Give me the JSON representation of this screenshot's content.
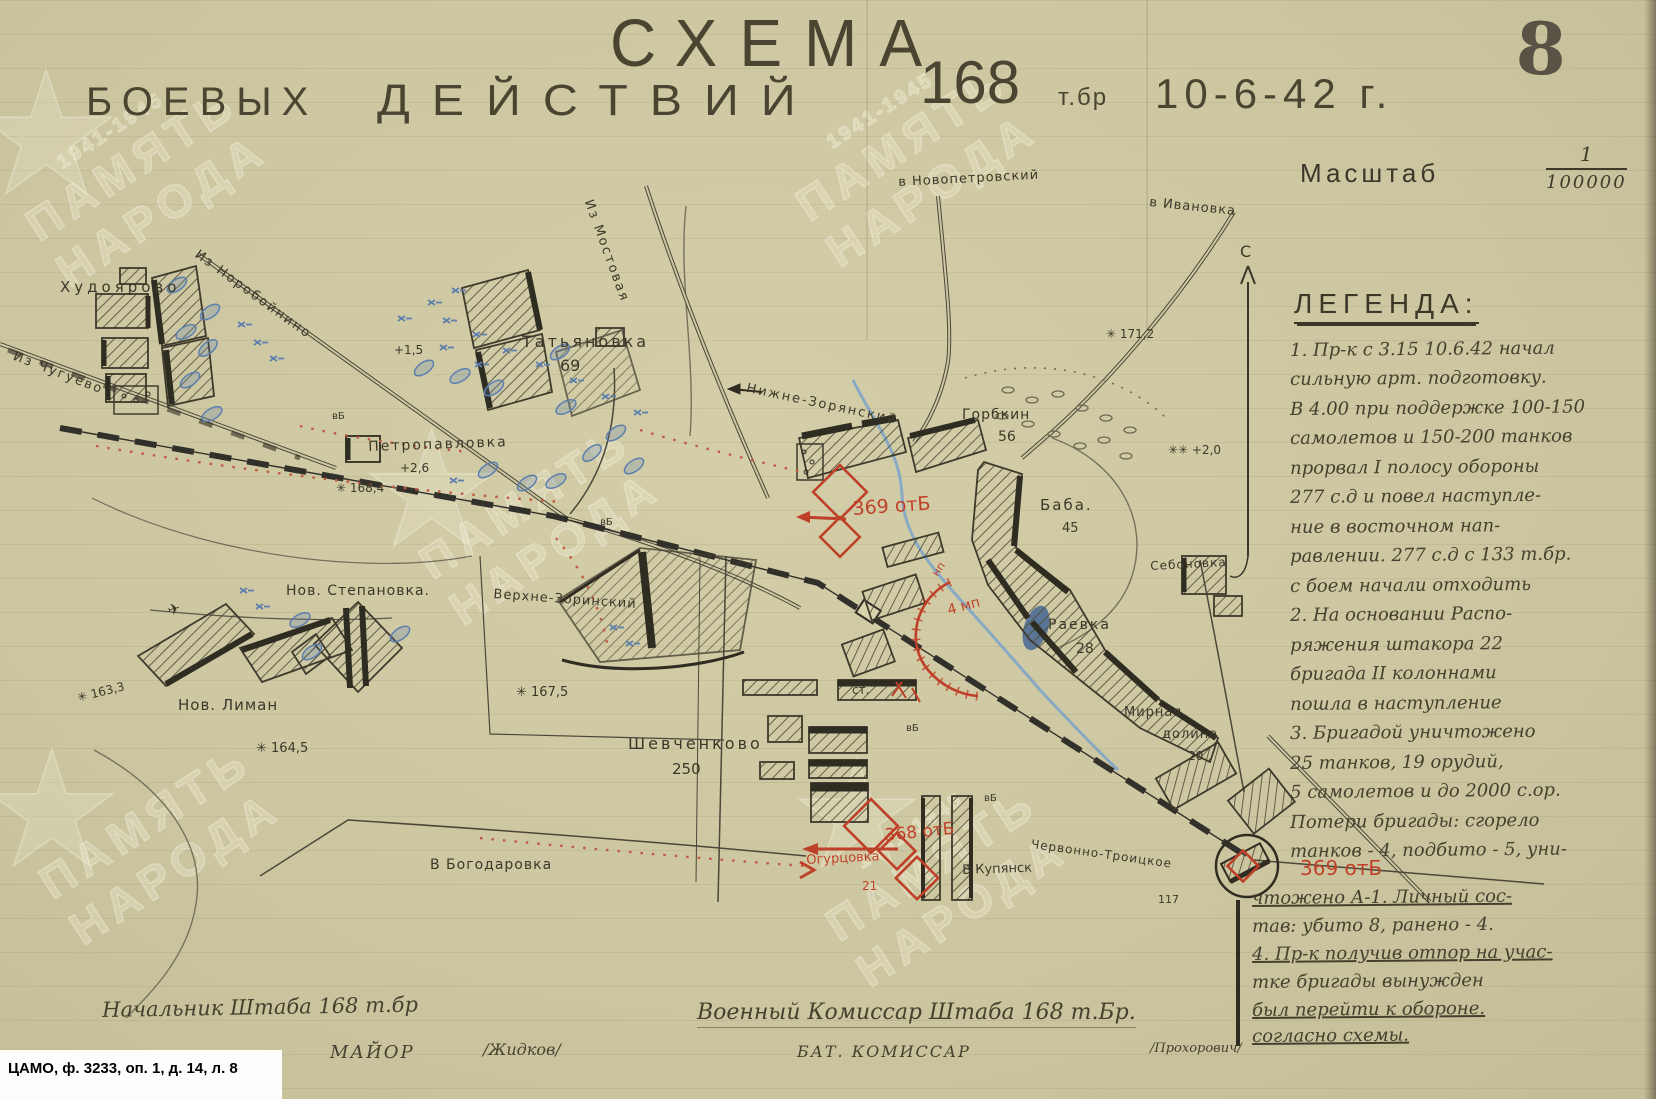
{
  "page": {
    "archive_ref": "ЦАМО, ф. 3233, оп. 1, д. 14, л. 8",
    "page_number": "8",
    "watermark_line1": "ПАМЯТЬ",
    "watermark_line2": "НАРОДА",
    "watermark_years": "1941-1945",
    "star_glyph": "★"
  },
  "header": {
    "title_line1": "СХЕМА",
    "title_word1": "БОЕВЫХ",
    "title_word2": "ДЕЙСТВИЙ",
    "unit_number": "168",
    "unit_suffix": "т.бр",
    "date": "10-6-42 г.",
    "scale_label": "Масштаб",
    "scale_num": "1",
    "scale_den": "100000"
  },
  "legend": {
    "north": "С",
    "title": "ЛЕГЕНДА:",
    "lines": [
      "1. Пр-к с 3.15 10.6.42 начал",
      "сильную арт. подготовку.",
      "В 4.00 при поддержке 100-150",
      "самолетов и 150-200 танков",
      "прорвал I полосу обороны",
      "277 с.д и повел наступле-",
      "ние в восточном нап-",
      "равлении. 277 с.д с 133 т.бр.",
      "с боем начали отходить",
      "2. На основании Распо-",
      "ряжения штакора 22",
      "бригада II колоннами",
      "пошла в наступление",
      "3. Бригадой уничтожено",
      "25 танков, 19 орудий,",
      "5 самолетов и до 2000 с.ор.",
      "Потери бригады: сгорело",
      "танков - 4, подбито - 5, уни-",
      "чтожено А-1. Личный сос-",
      "тав: убито 8, ранено - 4.",
      "4. Пр-к получив отпор на учас-",
      "тке бригады вынужден",
      "был перейти к обороне.",
      "согласно схемы."
    ]
  },
  "map": {
    "labels": {
      "hudoyarovo": "Худоярово",
      "iz_chugueva": "Из Чугуево",
      "iz_noroboynino": "Из Норобойнино",
      "iz_mostovaya": "Из Мостовая",
      "v_novopetrovskiy": "в Новопетровский",
      "v_ivanovka": "в Ивановка",
      "tatyanovka": "Татьяновка",
      "tatyanovka_h": "69",
      "petropavlovka": "Петропавловка",
      "plus26": "+2,6",
      "plus15": "+1,5",
      "h1684": "✳ 168,4",
      "nizhne_zorinskiy": "Нижне-Зорянский",
      "gorbkin": "Горбкин",
      "gorbkin_h": "56",
      "baba": "Баба.",
      "baba_h": "45",
      "raevka": "Раевка",
      "raevka_h": "28",
      "mirnaya1": "Мирная",
      "mirnaya2": "долина",
      "mirnaya_h": "20",
      "sebonovka": "Себоновка",
      "nov_stepanovka": "Нов. Степановка.",
      "verhne_zorinskiy": "Верхне-Зоринский",
      "h1675": "✳ 167,5",
      "nov_liman": "Нов. Лиман",
      "h1633": "✳ 163,3",
      "h1645": "✳ 164,5",
      "shevchenkovo": "Шевченково",
      "shevchenkovo_h": "250",
      "st": "ст.",
      "ogurtsovka": "Огурцовка",
      "ogurtsovka_h": "21",
      "otb368": "368 отБ",
      "otb369a": "369 отБ",
      "otb369b": "369 отБ",
      "mp4": "4 мп",
      "np": "нп",
      "chervonno": "Червонно-Троицкое",
      "chervonno_h": "117",
      "v_bogodarovka": "В Богодаровка",
      "v_kupyansk": "В Купянск",
      "h1712": "✳ 171,2",
      "plus20": "✳✳ +2,0",
      "vb": "вБ",
      "plane": "✈"
    }
  },
  "signatures": {
    "left_title": "Начальник Штаба 168 т.бр",
    "left_rank": "МАЙОР",
    "left_sign": "/Жидков/",
    "right_title": "Военный Комиссар Штаба 168 т.Бр.",
    "right_rank": "БАТ. КОМИССАР",
    "right_sign": "/Прохорович/"
  }
}
